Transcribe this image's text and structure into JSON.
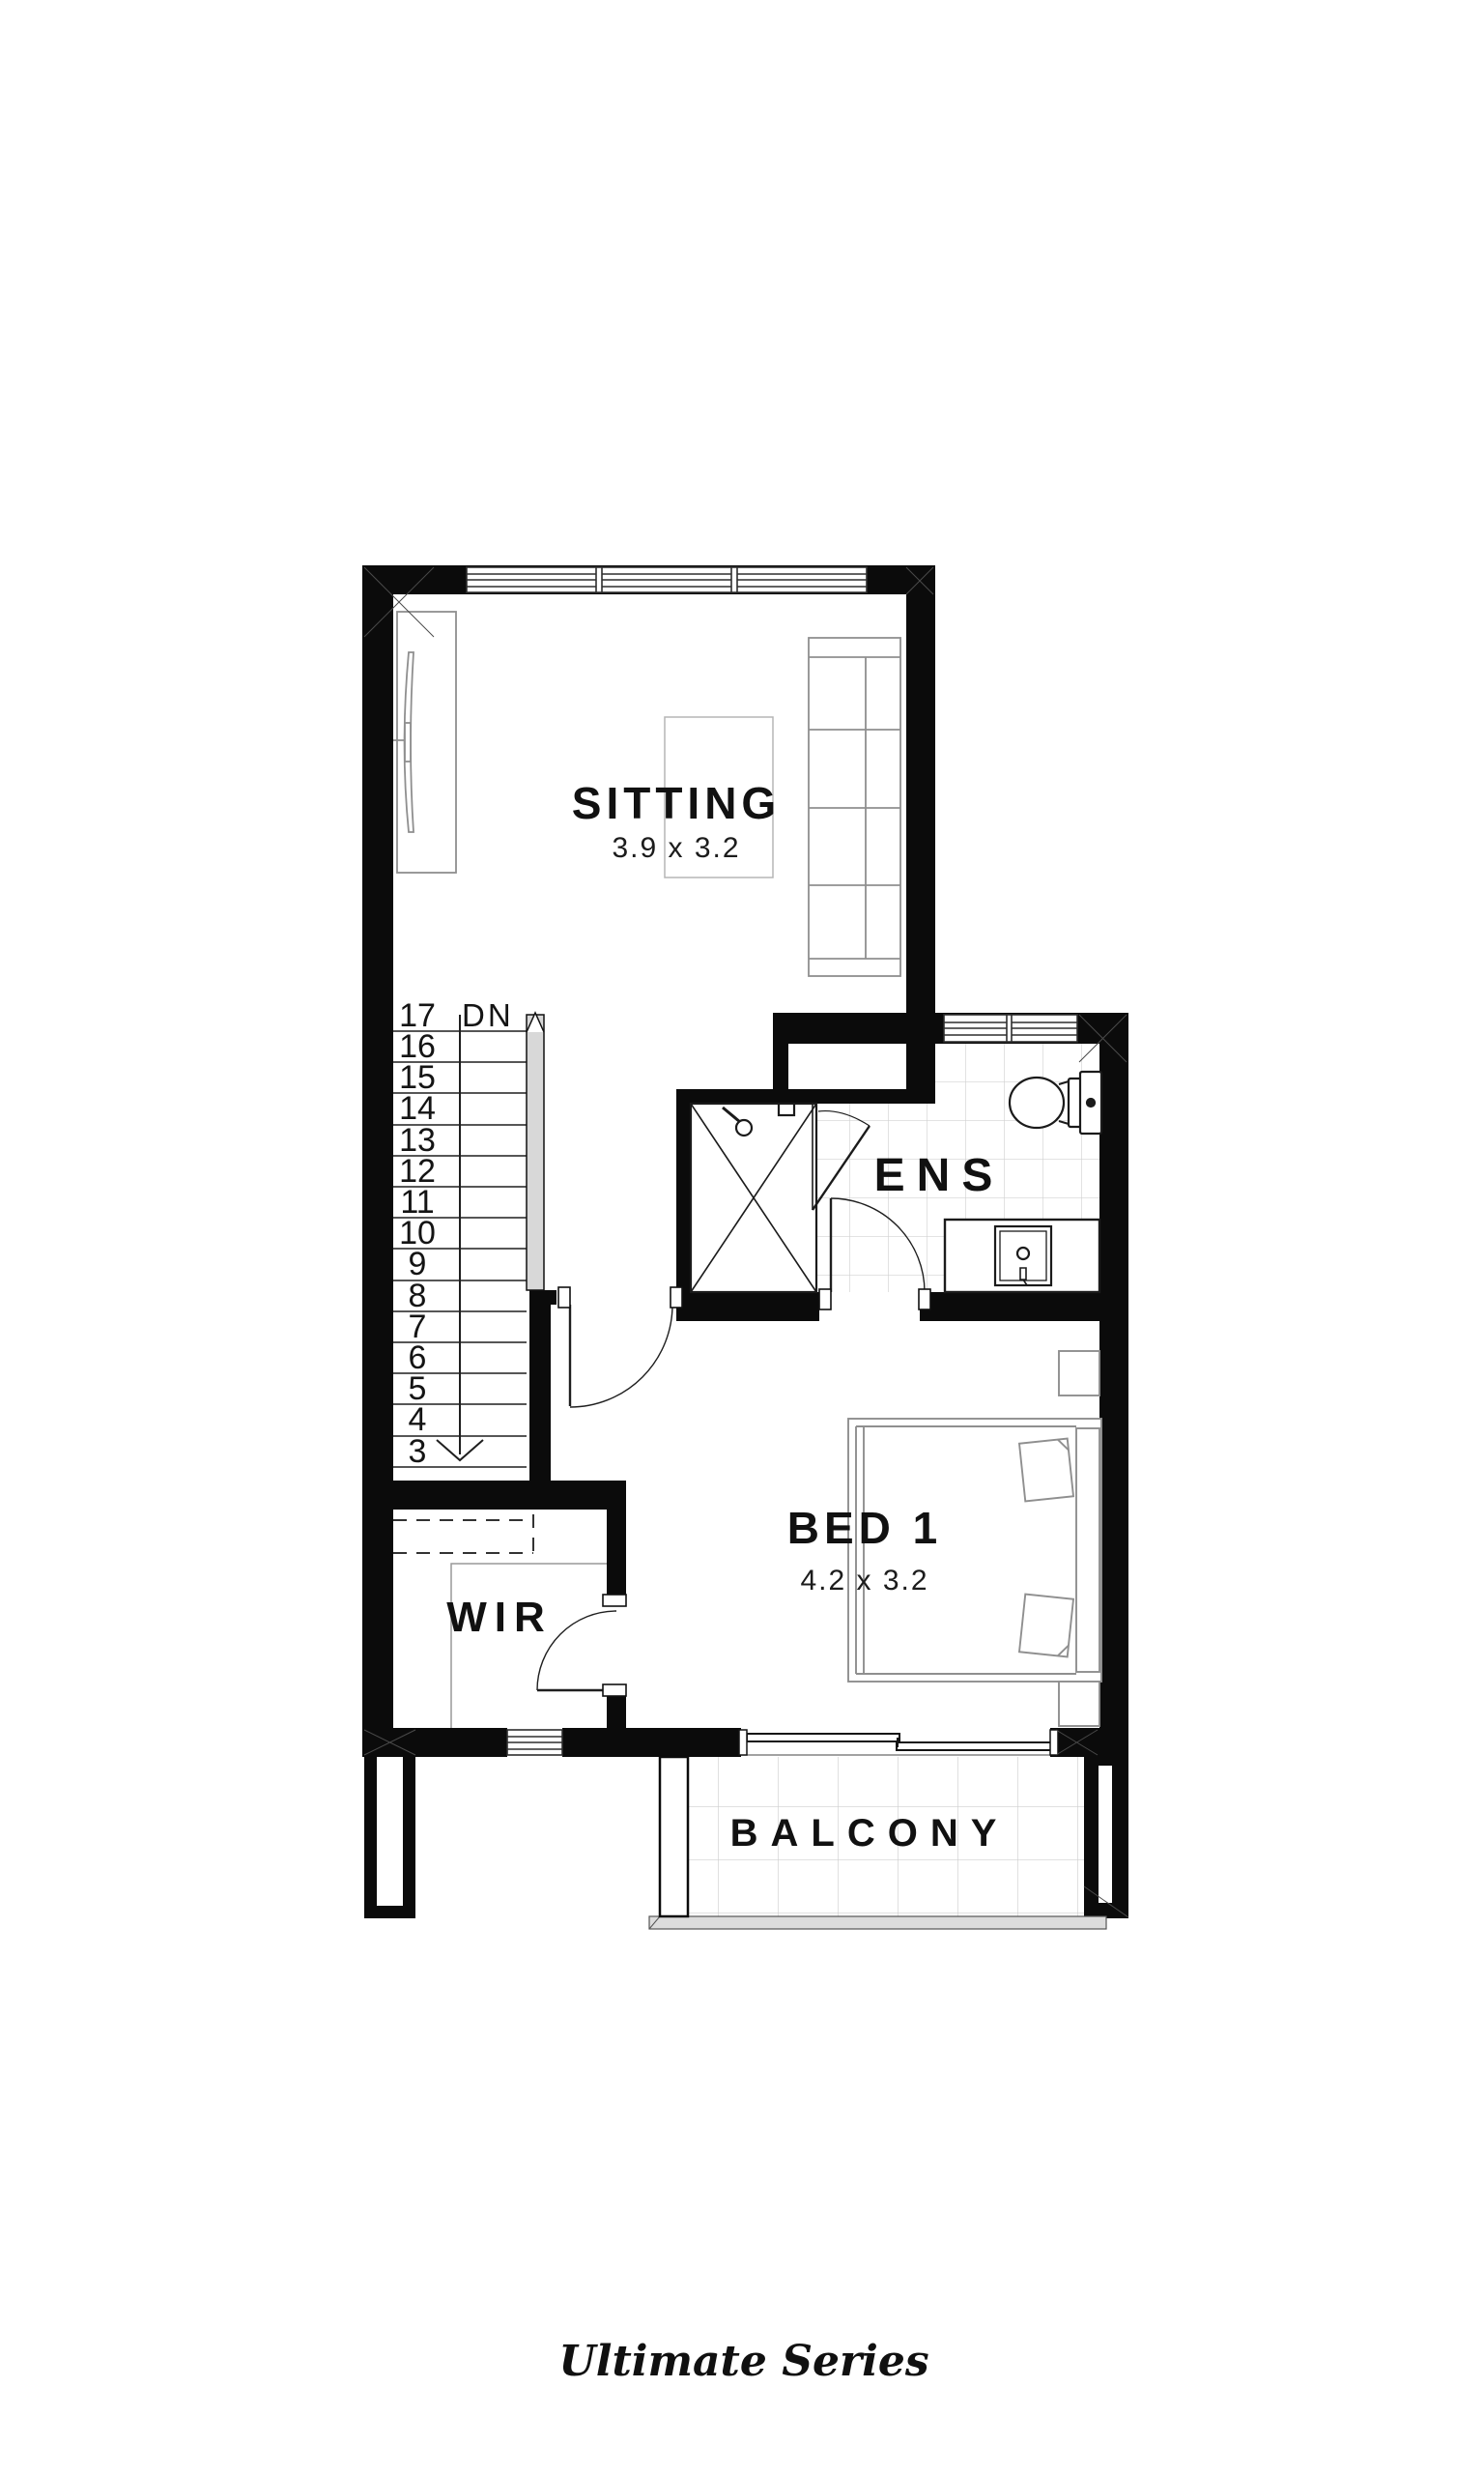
{
  "plan": {
    "rooms": {
      "sitting": {
        "name": "SITTING",
        "dims": "3.9 x 3.2"
      },
      "ens": {
        "name": "ENS"
      },
      "bed1": {
        "name": "BED 1",
        "dims": "4.2 x 3.2"
      },
      "wir": {
        "name": "WIR"
      },
      "balcony": {
        "name": "BALCONY"
      }
    },
    "stairs": {
      "dn_label": "DN",
      "steps": [
        "17",
        "16",
        "15",
        "14",
        "13",
        "12",
        "11",
        "10",
        "9",
        "8",
        "7",
        "6",
        "5",
        "4",
        "3"
      ]
    },
    "brand": {
      "text": "Ultimate Series"
    },
    "colors": {
      "wall": "#0b0b0b",
      "fixture_line": "#1b1b1b",
      "furniture_line": "#8f8f8f",
      "tile_line": "#d2d2d2",
      "handrail_fill": "#d8d8d8",
      "balustrade_fill": "#dcdcdc",
      "text": "#111111"
    }
  }
}
